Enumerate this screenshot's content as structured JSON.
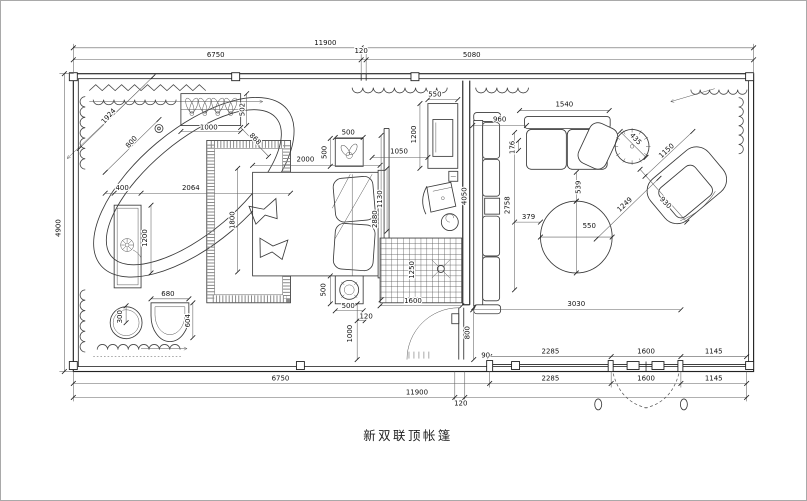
{
  "title": {
    "text": "新双联顶帐篷"
  },
  "colors": {
    "background": "#ffffff",
    "line": "#222222",
    "dim_text": "#111111",
    "frame_border": "#a9a9a9"
  },
  "dims": {
    "top_total": "11900",
    "top_seg_left": "6750",
    "top_seg_wall": "120",
    "top_seg_right": "5080",
    "left_height": "4900",
    "in_2285": "2285",
    "in_1600": "1600",
    "in_1145": "1145",
    "out_6750": "6750",
    "out_2285": "2285",
    "out_1600": "1600",
    "out_1145": "1145",
    "out_total": "11900",
    "out_120": "120",
    "tub_diag": "1924",
    "tub_width": "800",
    "planter_width": "1000",
    "planter_depth": "502",
    "vanity_offset": "400",
    "vanity_span": "2064",
    "vanity_length": "1200",
    "rug_height": "1800",
    "rug_diag": "868",
    "stool_diameter": "300",
    "chair_width": "680",
    "chair_depth": "604",
    "bed_width": "2000",
    "nightstand_top_width": "500",
    "nightstand_top_depth": "500",
    "nightstand_bottom_depth": "500",
    "nightstand_bottom_width": "500",
    "bed_wall": "2880",
    "bed_gap": "120",
    "bed_to_wall": "1000",
    "tv_width": "550",
    "tv_height": "1200",
    "tv_gap": "1050",
    "desk_gap": "1130",
    "mid_wall": "4050",
    "sofa_left_depth": "960",
    "sofa_gap": "176",
    "sofa_top_width": "1540",
    "sofa_left_length": "2758",
    "table_gap": "539",
    "table_offset": "379",
    "table_diameter": "550",
    "chair_diag": "1249",
    "armchair_width": "930",
    "armchair_diag": "1150",
    "plant_diameter": "435",
    "living_width": "3030",
    "shower_width": "1600",
    "shower_depth": "1250",
    "door_width": "800",
    "door_jamb": "90"
  },
  "furniture_icons": [
    "bathtub-icon",
    "planter-box-icon",
    "vanity-console-icon",
    "flower-icon",
    "stool-icon",
    "horseshoe-chair-icon",
    "area-rug-icon",
    "bed-icon",
    "pillow-icon",
    "nightstand-icon",
    "table-lamp-icon",
    "tv-cabinet-icon",
    "desk-chair-icon",
    "side-table-icon",
    "shower-floor-icon",
    "floor-drain-icon",
    "sofa-icon",
    "round-table-icon",
    "potted-plant-icon",
    "armchair-icon",
    "entry-door-icon",
    "french-door-icon",
    "curtain-icon"
  ]
}
